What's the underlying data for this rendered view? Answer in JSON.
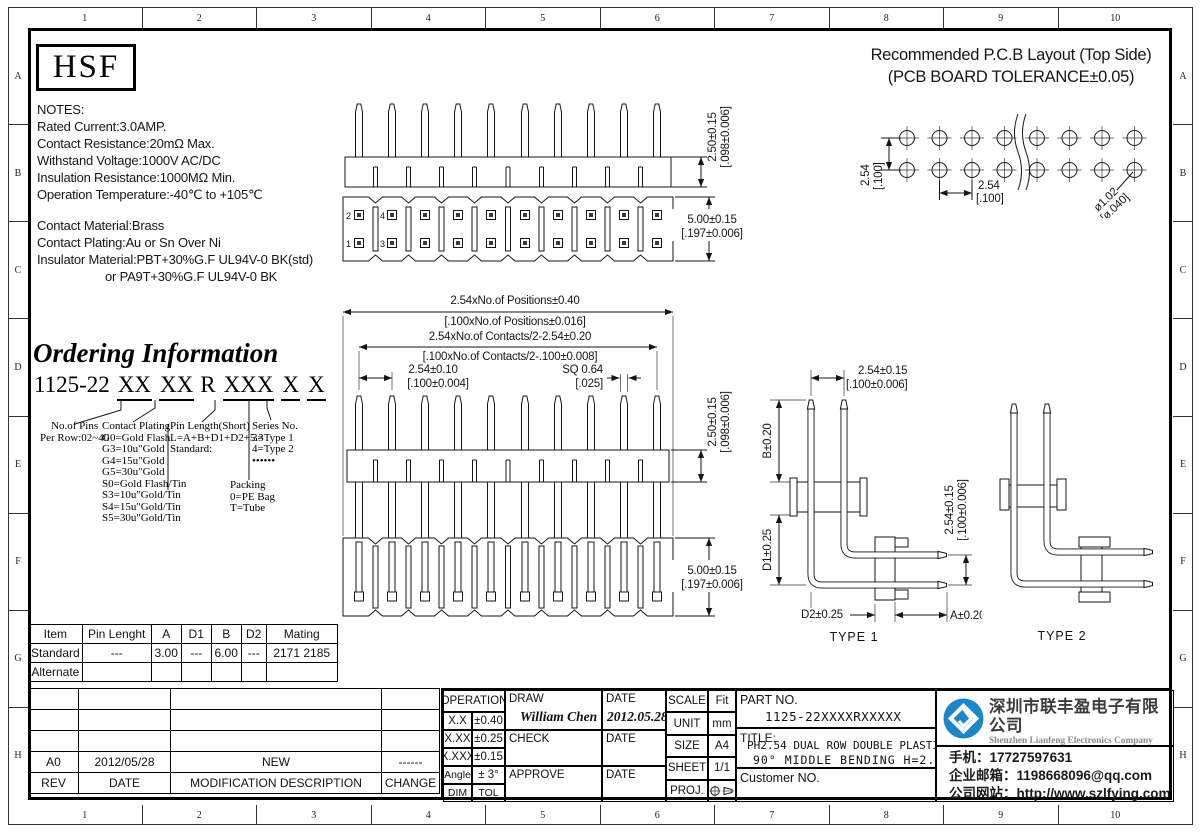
{
  "frame": {
    "cols": [
      "1",
      "2",
      "3",
      "4",
      "5",
      "6",
      "7",
      "8",
      "9",
      "10"
    ],
    "rows": [
      "A",
      "B",
      "C",
      "D",
      "E",
      "F",
      "G",
      "H"
    ]
  },
  "logo_box": {
    "text": "HSF"
  },
  "notes": {
    "title": "NOTES:",
    "line1": "Rated Current:3.0AMP.",
    "line2": "Contact Resistance:20mΩ Max.",
    "line3": "Withstand Voltage:1000V AC/DC",
    "line4": "Insulation Resistance:1000MΩ Min.",
    "line5": "Operation Temperature:-40℃ to +105℃",
    "line6": "Contact Material:Brass",
    "line7": "Contact Plating:Au or Sn Over Ni",
    "line8": "Insulator Material:PBT+30%G.F UL94V-0 BK(std)",
    "line9": "or PA9T+30%G.F UL94V-0 BK"
  },
  "pcb": {
    "title1": "Recommended P.C.B Layout (Top Side)",
    "title2": "(PCB BOARD TOLERANCE±0.05)",
    "row_pitch_mm": "2.54",
    "row_pitch_in": "[.100]",
    "col_pitch_mm": "2.54",
    "col_pitch_in": "[.100]",
    "hole_mm": "ø1.02",
    "hole_in": "[ø.040]"
  },
  "top_view": {
    "tail_mm": "2.50±0.15",
    "tail_in": "[.098±0.006]",
    "body_mm": "5.00±0.15",
    "body_in": "[.197±0.006]",
    "pin1": "1",
    "pin2": "2",
    "pin3": "3",
    "pin4": "4"
  },
  "front_view": {
    "pos_mm": "2.54xNo.of Positions±0.40",
    "pos_in": "[.100xNo.of Positions±0.016]",
    "cont_mm": "2.54xNo.of Contacts/2-2.54±0.20",
    "cont_in": "[.100xNo.of Contacts/2-.100±0.008]",
    "pitch_mm": "2.54±0.10",
    "pitch_in": "[.100±0.004]",
    "sq_mm": "SQ 0.64",
    "sq_in": "[.025]",
    "tail_mm": "2.50±0.15",
    "tail_in": "[.098±0.006]",
    "body_mm": "5.00±0.15",
    "body_in": "[.197±0.006]"
  },
  "type1": {
    "label": "TYPE 1",
    "top_mm": "2.54±0.15",
    "top_in": "[.100±0.006]",
    "b": "B±0.20",
    "d1": "D1±0.25",
    "d2": "D2±0.25",
    "a": "A±0.20",
    "right_mm": "2.54±0.15",
    "right_in": "[.100±0.006]"
  },
  "type2": {
    "label": "TYPE 2"
  },
  "ordering": {
    "title": "Ordering Information",
    "code_prefix": "1125-22",
    "code_g1": "XX",
    "code_g2": "XX",
    "code_r": "R",
    "code_g3": "XXX",
    "code_g4": "X",
    "code_g5": "X",
    "pins_t1": "No.of Pins",
    "pins_t2": "Per Row:02~40",
    "plating_title": "Contact Plating",
    "plating": [
      "G0=Gold Flash",
      "G3=10u\"Gold",
      "G4=15u\"Gold",
      "G5=30u\"Gold",
      "S0=Gold Flash/Tin",
      "S3=10u\"Gold/Tin",
      "S4=15u\"Gold/Tin",
      "S5=30u\"Gold/Tin"
    ],
    "pinlen_t1": "Pin Length(Short)",
    "pinlen_t2": "L=A+B+D1+D2+5.3",
    "pinlen_t3": "Standard:",
    "packing_t1": "Packing",
    "packing_t2": "0=PE Bag",
    "packing_t3": "T=Tube",
    "series_t1": "Series No.",
    "series_t2": "3=Type 1",
    "series_t3": "4=Type 2",
    "series_t4": "••••••"
  },
  "item_table": {
    "h": [
      "Item",
      "Pin Lenght",
      "A",
      "D1",
      "B",
      "D2",
      "Mating"
    ],
    "r1": [
      "Standard",
      "---",
      "3.00",
      "---",
      "6.00",
      "---",
      "2171 2185"
    ],
    "r2": [
      "Alternate",
      "",
      "",
      "",
      "",
      "",
      ""
    ]
  },
  "rev_table": {
    "a0": [
      "A0",
      "2012/05/28",
      "NEW",
      "------"
    ],
    "h": [
      "REV",
      "DATE",
      "MODIFICATION DESCRIPTION",
      "CHANGE"
    ]
  },
  "tb": {
    "operation": "OPERATION",
    "tol": [
      [
        "X.X",
        "±0.40"
      ],
      [
        "X.XX",
        "±0.25"
      ],
      [
        "X.XXX",
        "±0.15"
      ],
      [
        "Angle",
        "± 3°"
      ],
      [
        "DIM",
        "TOL"
      ]
    ],
    "draw": "DRAW",
    "draw_name": "William Chen",
    "date": "DATE",
    "draw_date": "2012.05.28",
    "check": "CHECK",
    "approve": "APPROVE",
    "scale": "SCALE",
    "scale_v": "Fit",
    "unit": "UNIT",
    "unit_v": "mm",
    "size": "SIZE",
    "size_v": "A4",
    "sheet": "SHEET",
    "sheet_v": "1/1",
    "proj": "PROJ.",
    "part_label": "PART NO.",
    "part_no": "1125-22XXXXRXXXXX",
    "title_label": "TITLE:",
    "title1": "PH2.54 DUAL ROW DOUBLE PLASTIC",
    "title2": "90° MIDDLE BENDING H=2.5",
    "customer": "Customer NO."
  },
  "company": {
    "name_cn": "深圳市联丰盈电子有限公司",
    "name_en": "Shenzhen Lianfeng Electronics Company Limited",
    "phone_label": "手机：",
    "phone": "17727597631",
    "email_label": "企业邮箱：",
    "email": "1198668096@qq.com",
    "web_label": "公司网站：",
    "web": "http://www.szlfying.com",
    "logo_blue": "#1d86c8"
  }
}
